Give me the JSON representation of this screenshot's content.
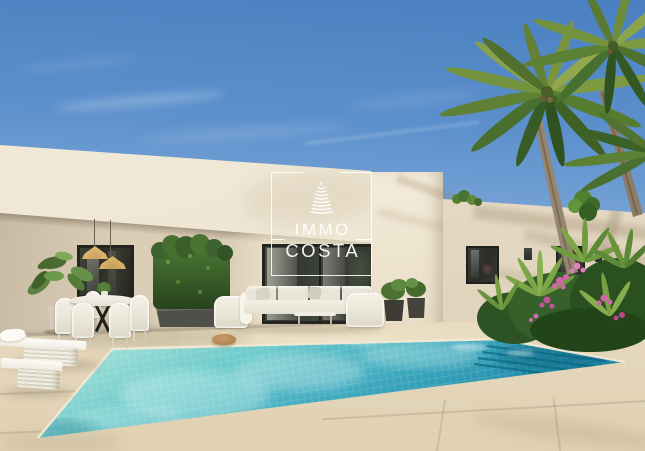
{
  "watermark": {
    "line1": "IMMO",
    "line2": "COSTA",
    "logo": "stacked-tower-icon"
  },
  "scene": {
    "description": "3D render of a modern white single-storey villa with flat roof, covered terrace, outdoor dining and lounge furniture, tropical garden with palm trees and a turquoise mosaic swimming pool with corner steps",
    "elements": [
      "sky",
      "main-facade",
      "terrace-porch",
      "side-wing",
      "dining-set",
      "pendant-lamps",
      "outdoor-sofa",
      "bamboo-hedge",
      "monstera-plant",
      "palm-trees",
      "bougainvillea",
      "sun-loungers",
      "swimming-pool",
      "stone-paving",
      "lawn"
    ]
  },
  "palette": {
    "sky_top": "#4a80c1",
    "sky_horizon": "#d3e2f3",
    "fascia": "#f1e9d7",
    "porch_wall": "#d6c9b2",
    "wing_wall": "#e6dac4",
    "paving": "#e4d6bb",
    "pool_shallow": "#abe2da",
    "pool_deep": "#1b7fa0",
    "waterline": "#f2e9d5",
    "window_frame": "#23231f",
    "foliage_green": "#47702e",
    "flower_pink": "#cc5ca6",
    "grass_green": "#5c9140",
    "rattan": "#d4a964",
    "lounger_white": "#fafaf5",
    "trunk_brown": "#97866f"
  }
}
